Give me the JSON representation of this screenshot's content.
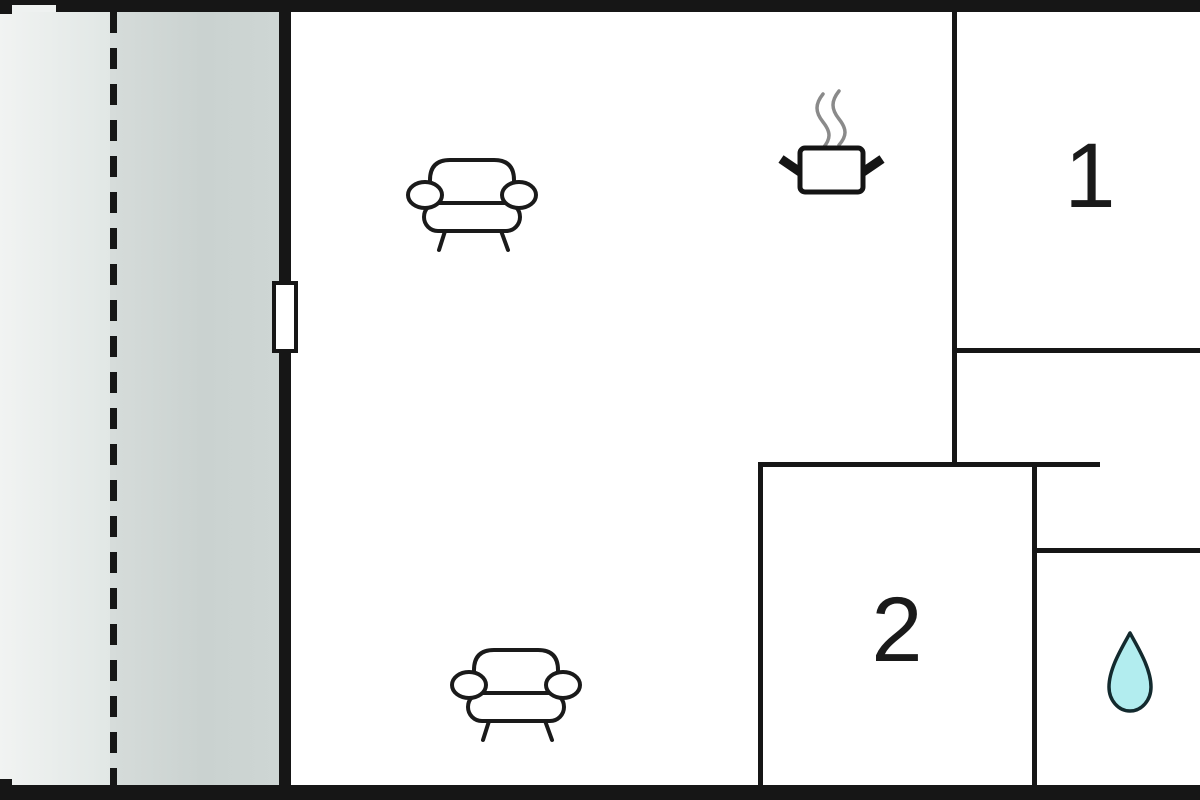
{
  "meta": {
    "type": "floor-plan"
  },
  "rooms": {
    "living_area": {
      "label": "",
      "features": [
        "sofa-icon",
        "sofa-icon",
        "cooking-pot-icon"
      ]
    },
    "bedroom_1": {
      "label": "1"
    },
    "bedroom_2": {
      "label": "2"
    },
    "bathroom": {
      "label": "",
      "features": [
        "water-drop-icon"
      ]
    },
    "terrace": {
      "label": "",
      "features": [
        "boundary-dashed-line"
      ]
    }
  },
  "icons": [
    {
      "name": "sofa-icon",
      "count": 2
    },
    {
      "name": "cooking-pot-icon",
      "count": 1
    },
    {
      "name": "water-drop-icon",
      "count": 1
    },
    {
      "name": "door-marker",
      "count": 1
    }
  ],
  "colors": {
    "wall": "#161616",
    "outline": "#1a1a1a",
    "outside_area": "#e9eeec",
    "terrace": "#ccd4d2",
    "water_drop_fill": "#b2edef",
    "steam": "#8a8a8a",
    "floor": "#ffffff"
  }
}
